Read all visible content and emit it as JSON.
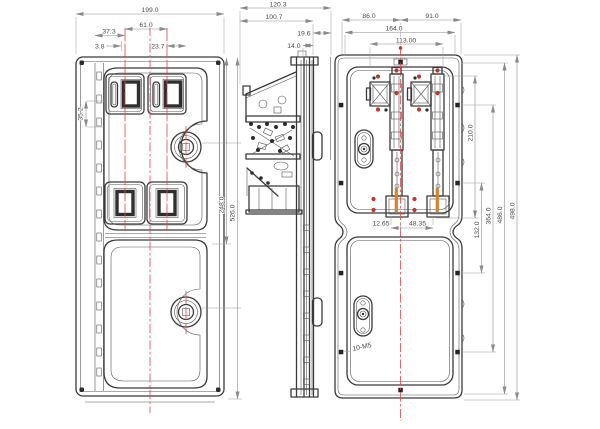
{
  "drawing": {
    "front_view": {
      "dims": {
        "overall_width": "199.0",
        "centers_spacing": "61.0",
        "edge_to_center": "37.3",
        "slot_offset": "3.8",
        "lock_offset": "23.7",
        "opening_height": "35.2",
        "upper_section_height": "248.0"
      }
    },
    "side_view": {
      "dims": {
        "overall_depth": "120.3",
        "body_depth": "100.7",
        "flange_depth": "19.6",
        "panel_gap": "14.0",
        "overall_height": "526.0"
      }
    },
    "rear_view": {
      "dims": {
        "center_to_left": "86.0",
        "center_to_right": "91.0",
        "opening_width": "164.0",
        "bolt_span": "113.00",
        "mech_offset": "12.65",
        "mech_spacing": "48.35",
        "mech_height": "210.0",
        "lower_span": "132.0",
        "bolt_height_span": "364.0",
        "inner_height": "486.0",
        "overall_height": "498.0"
      },
      "thread_note": "10-M5"
    }
  },
  "colors": {
    "line": "#3a3a3a",
    "dim_line": "#8a8a8a",
    "dim_text": "#4a4a4a",
    "centerline_red": "#e8433c",
    "screw_red": "#c23630",
    "accent_orange": "#d9822b",
    "background": "#ffffff"
  }
}
